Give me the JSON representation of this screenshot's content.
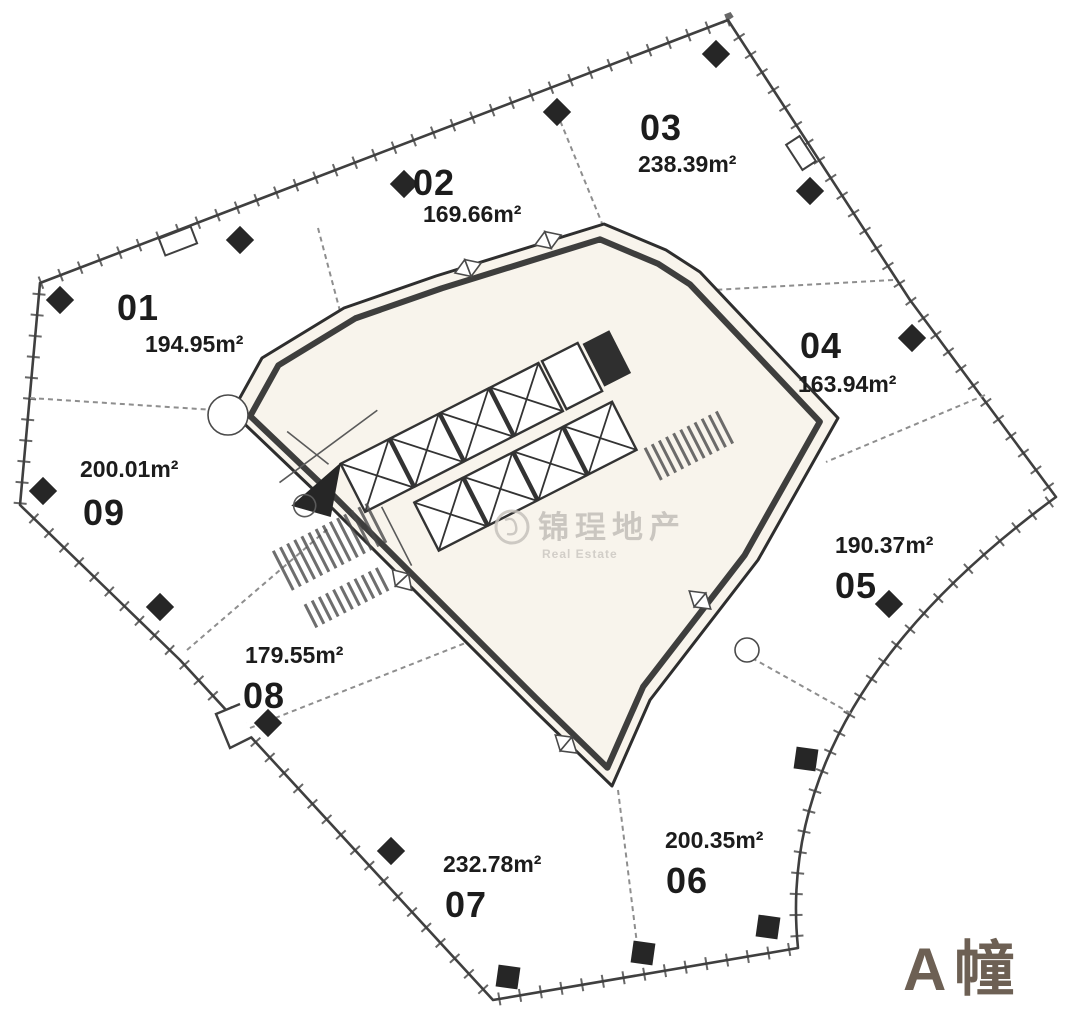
{
  "building": {
    "label": "A幢"
  },
  "watermark": {
    "text_cn": "锦珵地产",
    "text_en": "Real Estate"
  },
  "units": [
    {
      "number": "01",
      "area": "194.95m²"
    },
    {
      "number": "02",
      "area": "169.66m²"
    },
    {
      "number": "03",
      "area": "238.39m²"
    },
    {
      "number": "04",
      "area": "163.94m²"
    },
    {
      "number": "05",
      "area": "190.37m²"
    },
    {
      "number": "06",
      "area": "200.35m²"
    },
    {
      "number": "07",
      "area": "232.78m²"
    },
    {
      "number": "08",
      "area": "179.55m²"
    },
    {
      "number": "09",
      "area": "200.01m²"
    }
  ],
  "colors": {
    "wall_line": "#3f3f3f",
    "partition_line": "#8e8e8e",
    "core_fill": "#f8f4ec",
    "column": "#262626",
    "label_text": "#1c1c1c",
    "building_label": "#6d6054",
    "watermark": "#c3bfb9",
    "background": "#ffffff"
  }
}
